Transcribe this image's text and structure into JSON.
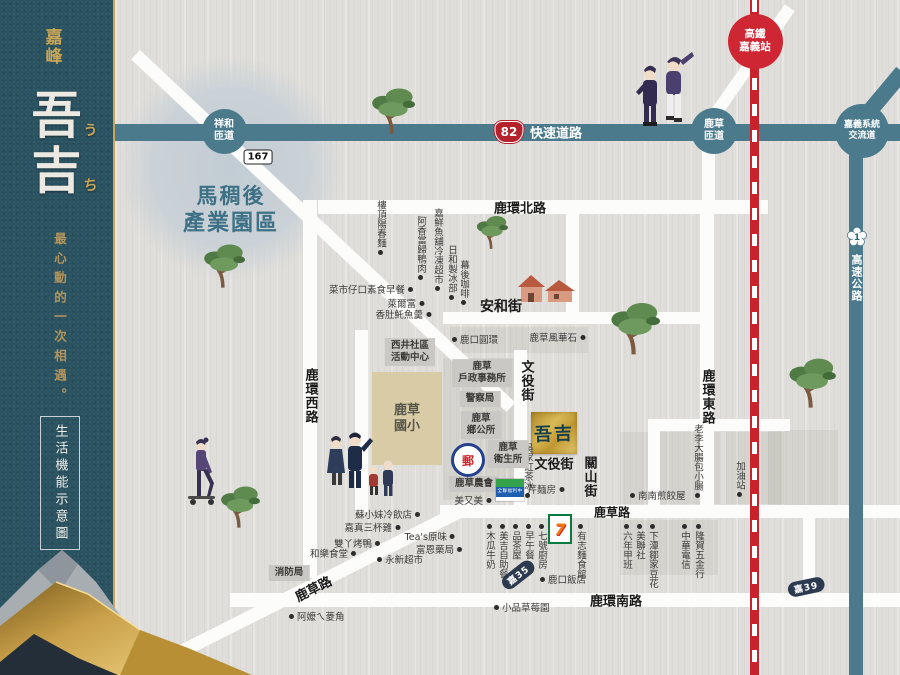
{
  "sidebar": {
    "brand_mark": "嘉峰",
    "brand_name_chars": [
      {
        "char": "吾",
        "kana": "う"
      },
      {
        "char": "吉",
        "kana": "ち"
      }
    ],
    "tagline": "最心動的一次相遇。",
    "footer_box": "生活機能示意圖"
  },
  "map": {
    "industrial_park": {
      "line1": "馬稠後",
      "line2": "產業園區"
    },
    "school": {
      "line1": "鹿草",
      "line2": "國小"
    },
    "site": {
      "name": "吾吉"
    },
    "logos": {
      "post": "郵",
      "seven": "7",
      "px": "全聯福利中心"
    },
    "interchanges": [
      {
        "id": "xianghe-ramp",
        "lines": [
          "祥和",
          "匝道"
        ],
        "x": 224,
        "y": 131,
        "d": 45,
        "color": "teal",
        "fs": 10
      },
      {
        "id": "lucao-ramp",
        "lines": [
          "鹿草",
          "匝道"
        ],
        "x": 714,
        "y": 131,
        "d": 46,
        "color": "teal",
        "fs": 10
      },
      {
        "id": "chiayi-system-interchange",
        "lines": [
          "嘉義系統",
          "交流道"
        ],
        "x": 862,
        "y": 131,
        "d": 54,
        "color": "teal",
        "fs": 9
      },
      {
        "id": "hsr-chiayi-station",
        "lines": [
          "高鐵",
          "嘉義站"
        ],
        "x": 755,
        "y": 41,
        "d": 55,
        "color": "red",
        "fs": 10.5
      }
    ],
    "badges": [
      {
        "type": "county",
        "text": "167",
        "x": 258,
        "y": 157,
        "rot": 0
      },
      {
        "type": "shield",
        "text": "82",
        "x": 509,
        "y": 132,
        "rot": 0
      },
      {
        "type": "blossom",
        "text": "1",
        "x": 857,
        "y": 237,
        "rot": 0
      },
      {
        "type": "tag",
        "text": "嘉35",
        "x": 518,
        "y": 575,
        "rot": -38
      },
      {
        "type": "tag",
        "text": "嘉39",
        "x": 806,
        "y": 587,
        "rot": -12
      }
    ],
    "road_labels": [
      {
        "text": "快速道路",
        "x": 556,
        "y": 132,
        "v": false,
        "color": "#ffffff",
        "fs": 13,
        "rot": 0
      },
      {
        "text": "高速公路",
        "x": 856,
        "y": 278,
        "v": true,
        "color": "#ffffff",
        "fs": 11,
        "rot": 0
      },
      {
        "text": "鹿環北路",
        "x": 520,
        "y": 207,
        "v": false,
        "color": "#1a1a1a",
        "fs": 13,
        "rot": 0
      },
      {
        "text": "鹿環西路",
        "x": 310,
        "y": 396,
        "v": true,
        "color": "#1a1a1a",
        "fs": 13,
        "rot": 0
      },
      {
        "text": "鹿環東路",
        "x": 707,
        "y": 397,
        "v": true,
        "color": "#1a1a1a",
        "fs": 13,
        "rot": 0
      },
      {
        "text": "鹿環南路",
        "x": 616,
        "y": 600,
        "v": false,
        "color": "#1a1a1a",
        "fs": 13,
        "rot": 0
      },
      {
        "text": "安和街",
        "x": 501,
        "y": 306,
        "v": false,
        "color": "#1a1a1a",
        "fs": 14,
        "rot": 0
      },
      {
        "text": "文役街",
        "x": 526,
        "y": 381,
        "v": true,
        "color": "#1a1a1a",
        "fs": 13,
        "rot": 0
      },
      {
        "text": "文役街",
        "x": 554,
        "y": 463,
        "v": false,
        "color": "#1a1a1a",
        "fs": 13,
        "rot": 0
      },
      {
        "text": "關山街",
        "x": 589,
        "y": 477,
        "v": true,
        "color": "#1a1a1a",
        "fs": 13,
        "rot": 0
      },
      {
        "text": "鹿草路",
        "x": 313,
        "y": 588,
        "v": false,
        "color": "#1a1a1a",
        "fs": 13,
        "rot": -27
      },
      {
        "text": "鹿草路",
        "x": 612,
        "y": 512,
        "v": false,
        "color": "#1a1a1a",
        "fs": 12,
        "rot": 0
      }
    ],
    "pois": [
      {
        "t": "樓頂陽春麵",
        "x": 380,
        "y": 200,
        "dir": "v",
        "dot": "bottom"
      },
      {
        "t": "阿香當歸鴨肉",
        "x": 420,
        "y": 216,
        "dir": "v",
        "dot": "bottom"
      },
      {
        "t": "嘉鮮魚舖冷凍超市",
        "x": 437,
        "y": 208,
        "dir": "v",
        "dot": "bottom"
      },
      {
        "t": "日和製冰部",
        "x": 451,
        "y": 245,
        "dir": "v",
        "dot": "bottom"
      },
      {
        "t": "幕後咖啡",
        "x": 463,
        "y": 260,
        "dir": "v",
        "dot": "bottom"
      },
      {
        "t": "菜市仔口素食早餐",
        "x": 413,
        "y": 289,
        "dir": "h",
        "dot": "end"
      },
      {
        "t": "萊爾富",
        "x": 424,
        "y": 303,
        "dir": "h",
        "dot": "end"
      },
      {
        "t": "香肚魠魚羹",
        "x": 431,
        "y": 314,
        "dir": "h",
        "dot": "end"
      },
      {
        "t": "鹿口圓環",
        "x": 452,
        "y": 339,
        "dir": "h",
        "dot": "start"
      },
      {
        "t": "鹿草風華石",
        "x": 585,
        "y": 337,
        "dir": "h",
        "dot": "end"
      },
      {
        "t": "吳家紅茶冰",
        "x": 527,
        "y": 443,
        "dir": "v",
        "dot": "bottom"
      },
      {
        "t": "芹麵房",
        "x": 564,
        "y": 489,
        "dir": "h",
        "dot": "end"
      },
      {
        "t": "美又美",
        "x": 491,
        "y": 500,
        "dir": "h",
        "dot": "end"
      },
      {
        "t": "木瓜牛奶",
        "x": 489,
        "y": 524,
        "dir": "v",
        "dot": "top"
      },
      {
        "t": "美吉自助餐",
        "x": 502,
        "y": 524,
        "dir": "v",
        "dot": "top"
      },
      {
        "t": "品茶屋",
        "x": 515,
        "y": 524,
        "dir": "v",
        "dot": "top"
      },
      {
        "t": "早午餐",
        "x": 528,
        "y": 524,
        "dir": "v",
        "dot": "top"
      },
      {
        "t": "七號廚房",
        "x": 541,
        "y": 524,
        "dir": "v",
        "dot": "top"
      },
      {
        "t": "有志麵食館",
        "x": 580,
        "y": 524,
        "dir": "v",
        "dot": "top"
      },
      {
        "t": "蘇小妹冷飲店",
        "x": 420,
        "y": 514,
        "dir": "h",
        "dot": "end"
      },
      {
        "t": "嘉真三杯雞",
        "x": 400,
        "y": 527,
        "dir": "h",
        "dot": "end"
      },
      {
        "t": "雙丫烤鴨",
        "x": 380,
        "y": 543,
        "dir": "h",
        "dot": "end"
      },
      {
        "t": "和樂食堂",
        "x": 356,
        "y": 553,
        "dir": "h",
        "dot": "end"
      },
      {
        "t": "永新超市",
        "x": 377,
        "y": 559,
        "dir": "h",
        "dot": "start"
      },
      {
        "t": "Tea's原味",
        "x": 455,
        "y": 536,
        "dir": "h",
        "dot": "end"
      },
      {
        "t": "富恩藥局",
        "x": 462,
        "y": 549,
        "dir": "h",
        "dot": "end"
      },
      {
        "t": "阿嬤ㄟ菱角",
        "x": 289,
        "y": 616,
        "dir": "h",
        "dot": "start"
      },
      {
        "t": "小品草莓園",
        "x": 494,
        "y": 607,
        "dir": "h",
        "dot": "start"
      },
      {
        "t": "鹿口飯店",
        "x": 540,
        "y": 579,
        "dir": "h",
        "dot": "start"
      },
      {
        "t": "南南煎餃屋",
        "x": 630,
        "y": 495,
        "dir": "h",
        "dot": "start"
      },
      {
        "t": "老李大腸包小腸",
        "x": 697,
        "y": 424,
        "dir": "v",
        "dot": "bottom"
      },
      {
        "t": "加油站",
        "x": 739,
        "y": 461,
        "dir": "v",
        "dot": "bottom"
      },
      {
        "t": "六年甲班",
        "x": 626,
        "y": 524,
        "dir": "v",
        "dot": "top"
      },
      {
        "t": "美聯社",
        "x": 639,
        "y": 524,
        "dir": "v",
        "dot": "top"
      },
      {
        "t": "下潭鄒家豆花",
        "x": 652,
        "y": 524,
        "dir": "v",
        "dot": "top"
      },
      {
        "t": "中華電信",
        "x": 684,
        "y": 524,
        "dir": "v",
        "dot": "top"
      },
      {
        "t": "隆賀五金行",
        "x": 698,
        "y": 524,
        "dir": "v",
        "dot": "top"
      }
    ],
    "info_boxes": [
      {
        "lines": [
          "西井社區",
          "活動中心"
        ],
        "x": 410,
        "y": 352
      },
      {
        "lines": [
          "鹿草",
          "戶政事務所"
        ],
        "x": 482,
        "y": 373
      },
      {
        "lines": [
          "警察局"
        ],
        "x": 480,
        "y": 399
      },
      {
        "lines": [
          "鹿草",
          "鄉公所"
        ],
        "x": 481,
        "y": 425
      },
      {
        "lines": [
          "鹿草",
          "衛生所"
        ],
        "x": 508,
        "y": 454
      },
      {
        "lines": [
          "鹿草農會"
        ],
        "x": 474,
        "y": 484
      },
      {
        "lines": [
          "消防局"
        ],
        "x": 289,
        "y": 573
      }
    ]
  }
}
